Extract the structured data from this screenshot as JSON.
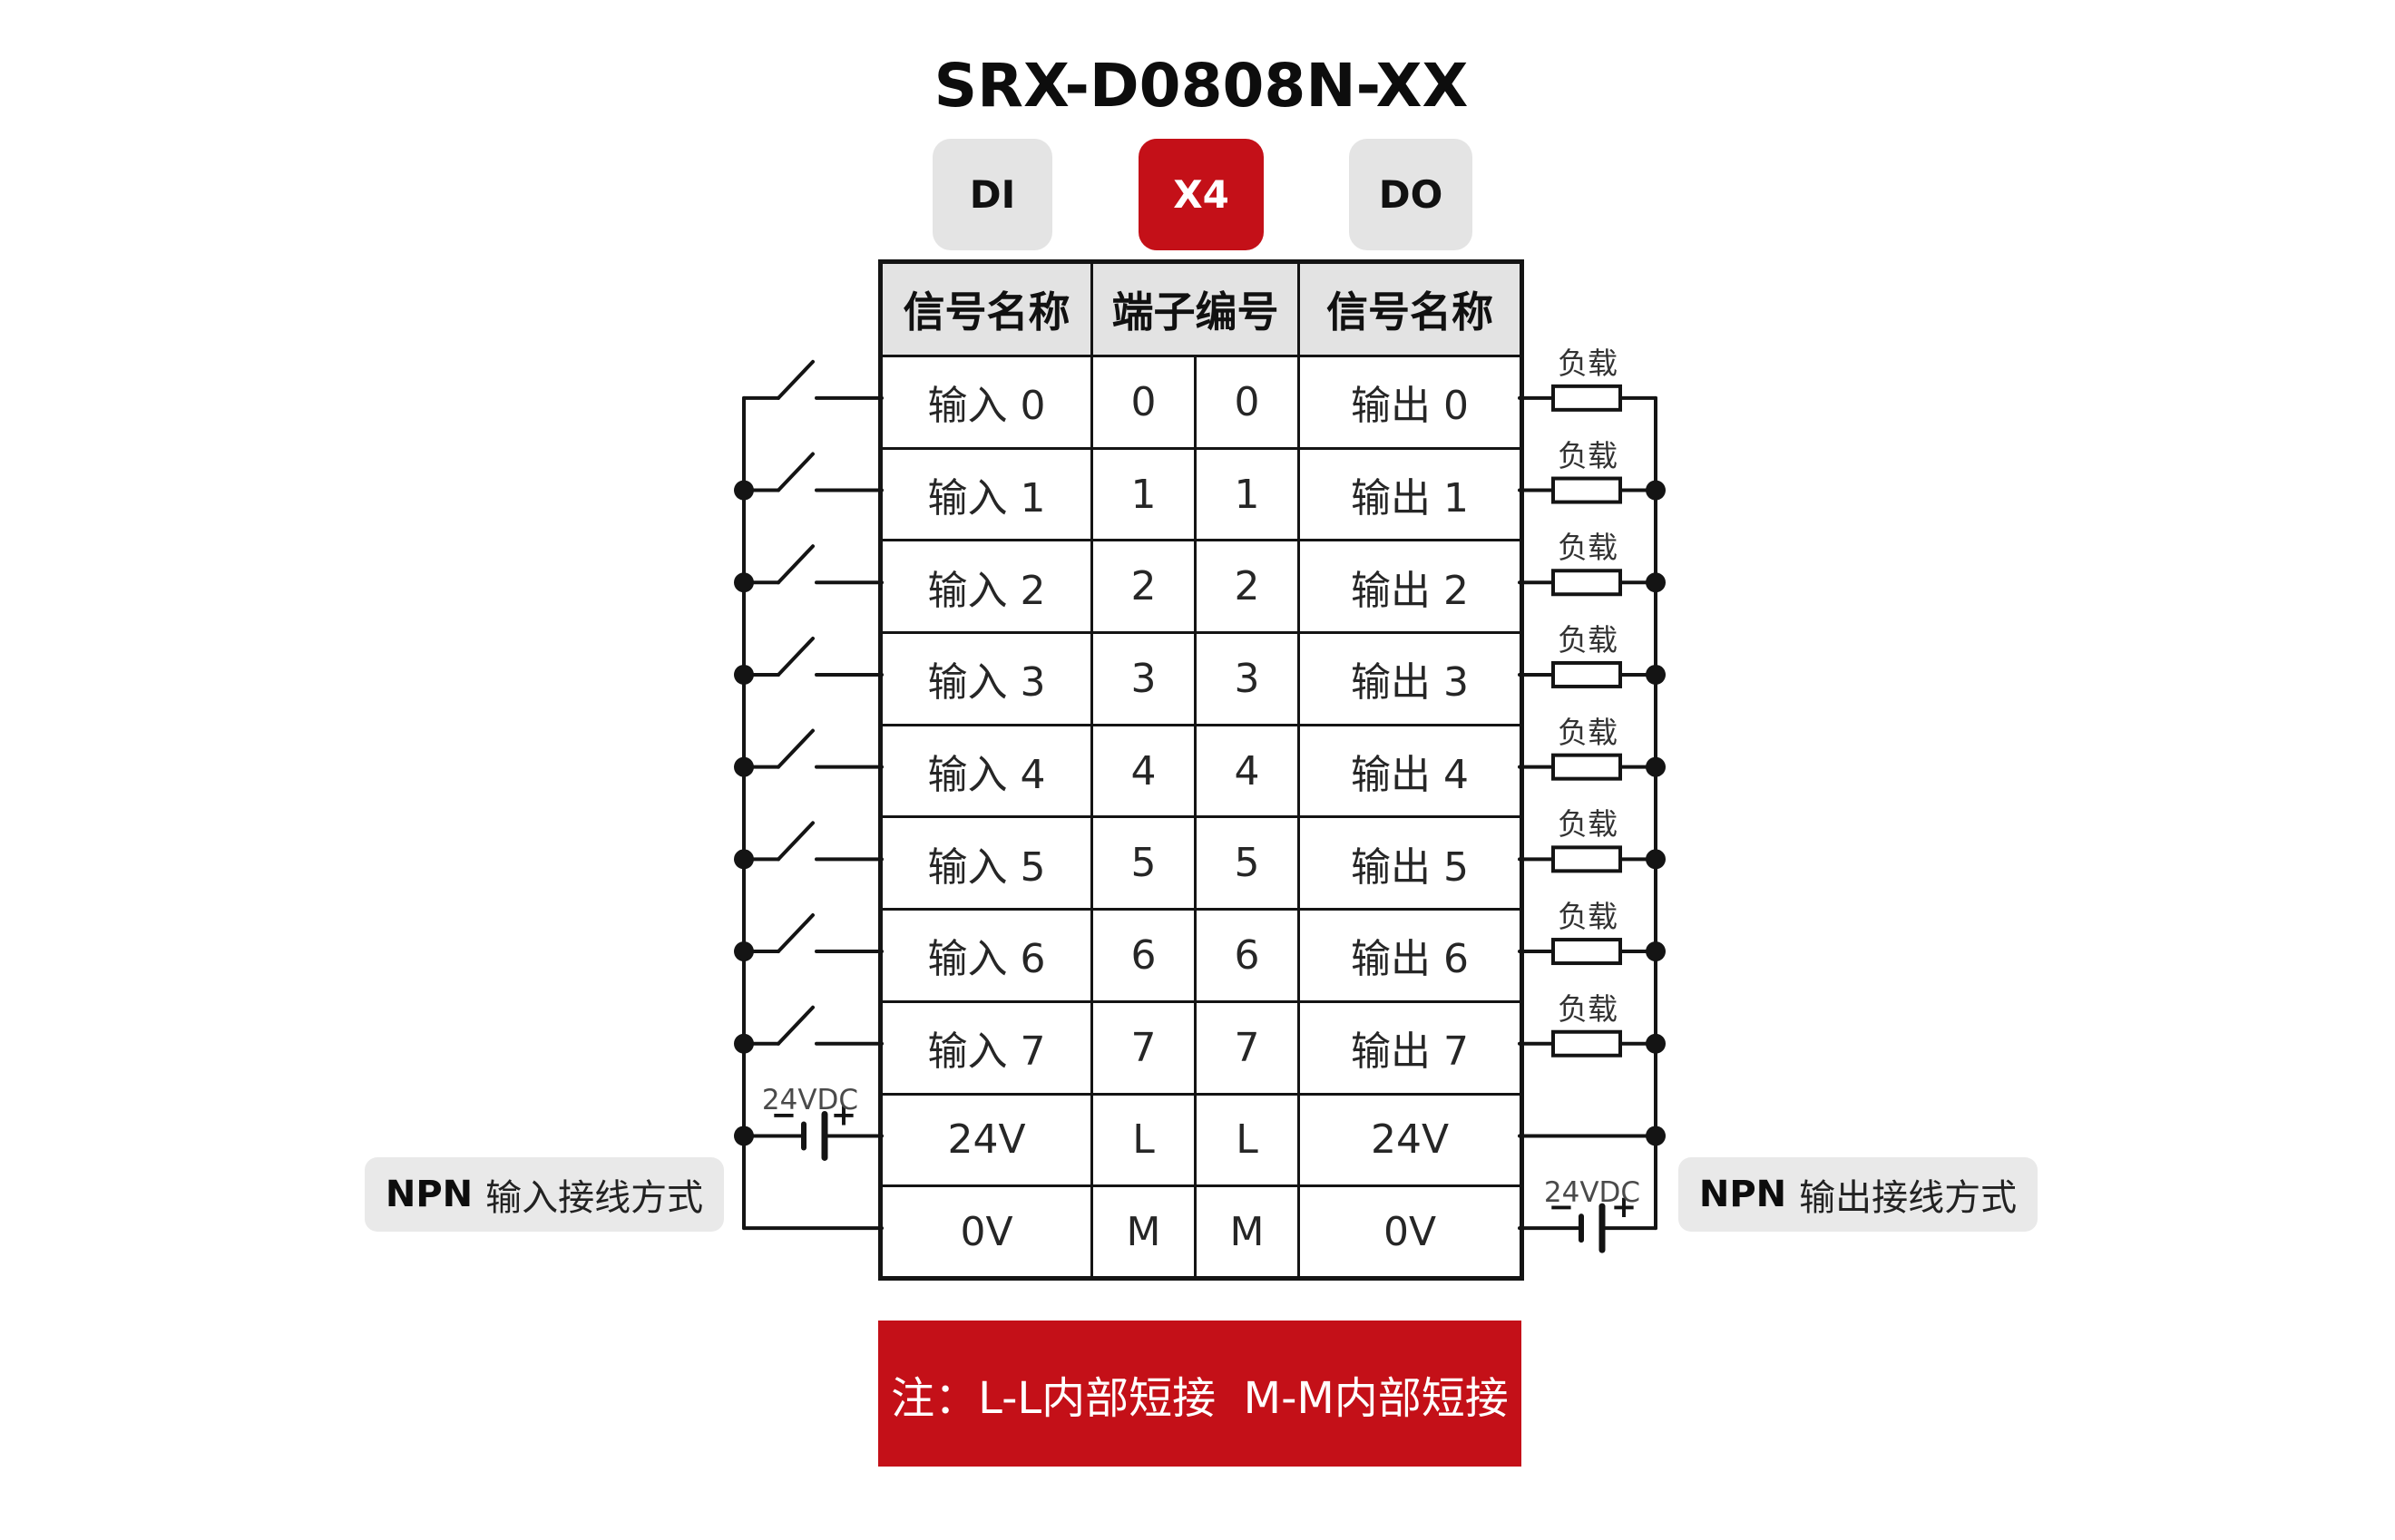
{
  "title": "SRX-D0808N-XX",
  "tabs": [
    {
      "label": "DI",
      "active": false
    },
    {
      "label": "X4",
      "active": true
    },
    {
      "label": "DO",
      "active": false
    }
  ],
  "table": {
    "headers": [
      "信号名称",
      "端子编号",
      "信号名称"
    ],
    "rows": [
      [
        "输入 0",
        "0",
        "0",
        "输出 0"
      ],
      [
        "输入 1",
        "1",
        "1",
        "输出 1"
      ],
      [
        "输入 2",
        "2",
        "2",
        "输出 2"
      ],
      [
        "输入 3",
        "3",
        "3",
        "输出 3"
      ],
      [
        "输入 4",
        "4",
        "4",
        "输出 4"
      ],
      [
        "输入 5",
        "5",
        "5",
        "输出 5"
      ],
      [
        "输入 6",
        "6",
        "6",
        "输出 6"
      ],
      [
        "输入 7",
        "7",
        "7",
        "输出 7"
      ],
      [
        "24V",
        "L",
        "L",
        "24V"
      ],
      [
        "0V",
        "M",
        "M",
        "0V"
      ]
    ]
  },
  "diagram": {
    "load_label": "负载",
    "left_supply_label": "24VDC",
    "right_supply_label": "24VDC",
    "battery_minus": "−",
    "battery_plus": "+",
    "left_caption": {
      "bold": "NPN",
      "rest": "输入接线方式"
    },
    "right_caption": {
      "bold": "NPN",
      "rest": "输出接线方式"
    }
  },
  "note_banner": "注：L-L内部短接  M-M内部短接",
  "colors": {
    "accent_red": "#c41018",
    "tab_inactive_bg": "#e4e4e4",
    "table_header_bg": "#e3e3e3",
    "caption_bg": "#e9e9e9",
    "line_black": "#141414",
    "banner_text": "#ffffff"
  }
}
